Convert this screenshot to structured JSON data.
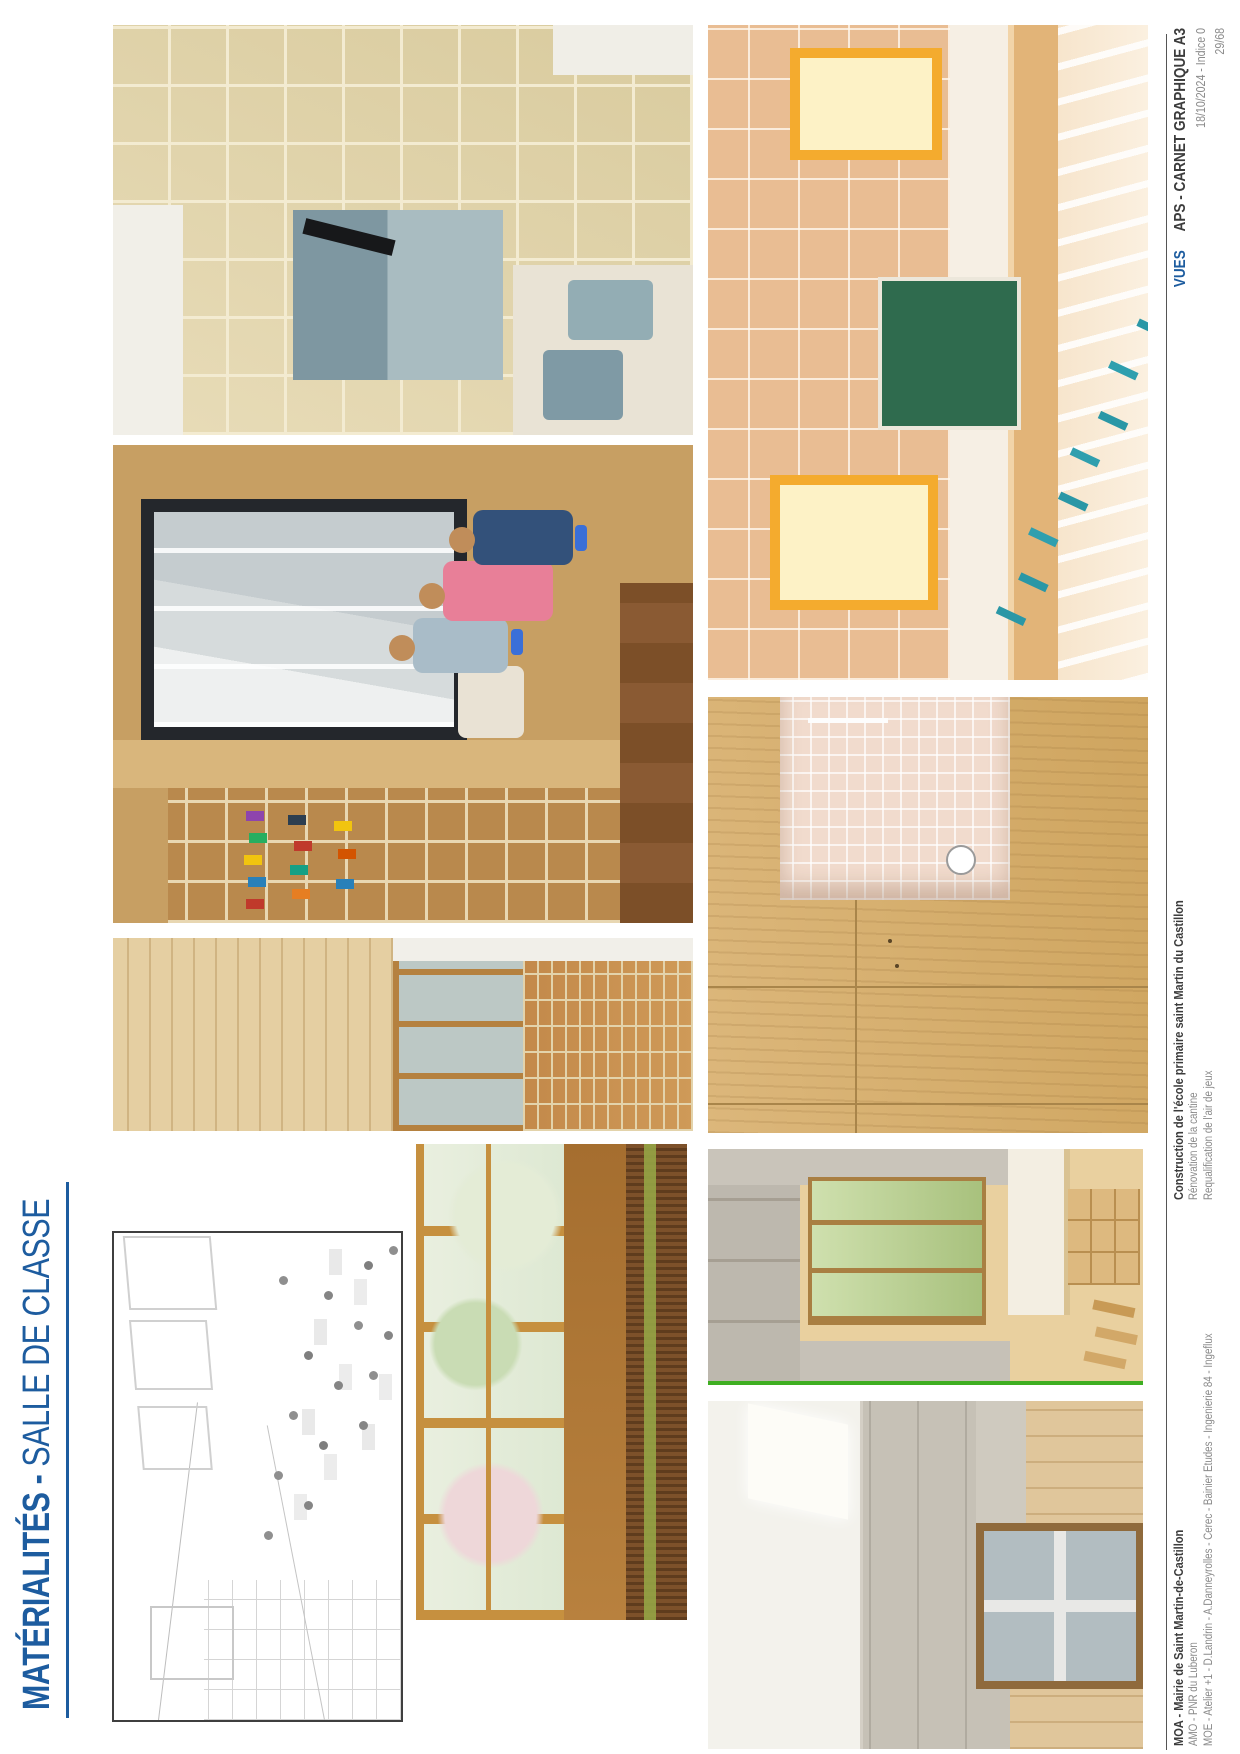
{
  "title": {
    "main": "MATÉRIALITÉS",
    "sep": " - ",
    "sub": "SALLE DE CLASSE"
  },
  "footer": {
    "moa": {
      "line1": "MOA - Mairie de Saint Martin-de-Castillon",
      "line2": "AMO - PNR du Luberon",
      "line3": "MOE - Atelier +1 - D.Landrin - A.Danneyrolles - Cerec - Bainier Etudes - Ingenierie 84 - Ingeflux"
    },
    "project": {
      "line1": "Construction de l'école primaire saint Martin du Castillon",
      "line2": "Rénovation de la cantine",
      "line3": "Requalification de l'air de jeux"
    },
    "meta": {
      "label": "VUES",
      "doc": "APS - CARNET GRAPHIQUE A3",
      "date_line": "18/10/2024 - Indice 0",
      "page_num": "29/68"
    }
  },
  "colors": {
    "accent_blue": "#1d5c9f",
    "text_dark": "#3c3c3c",
    "text_gray": "#8a8a8a",
    "rule_gray": "#555555"
  }
}
